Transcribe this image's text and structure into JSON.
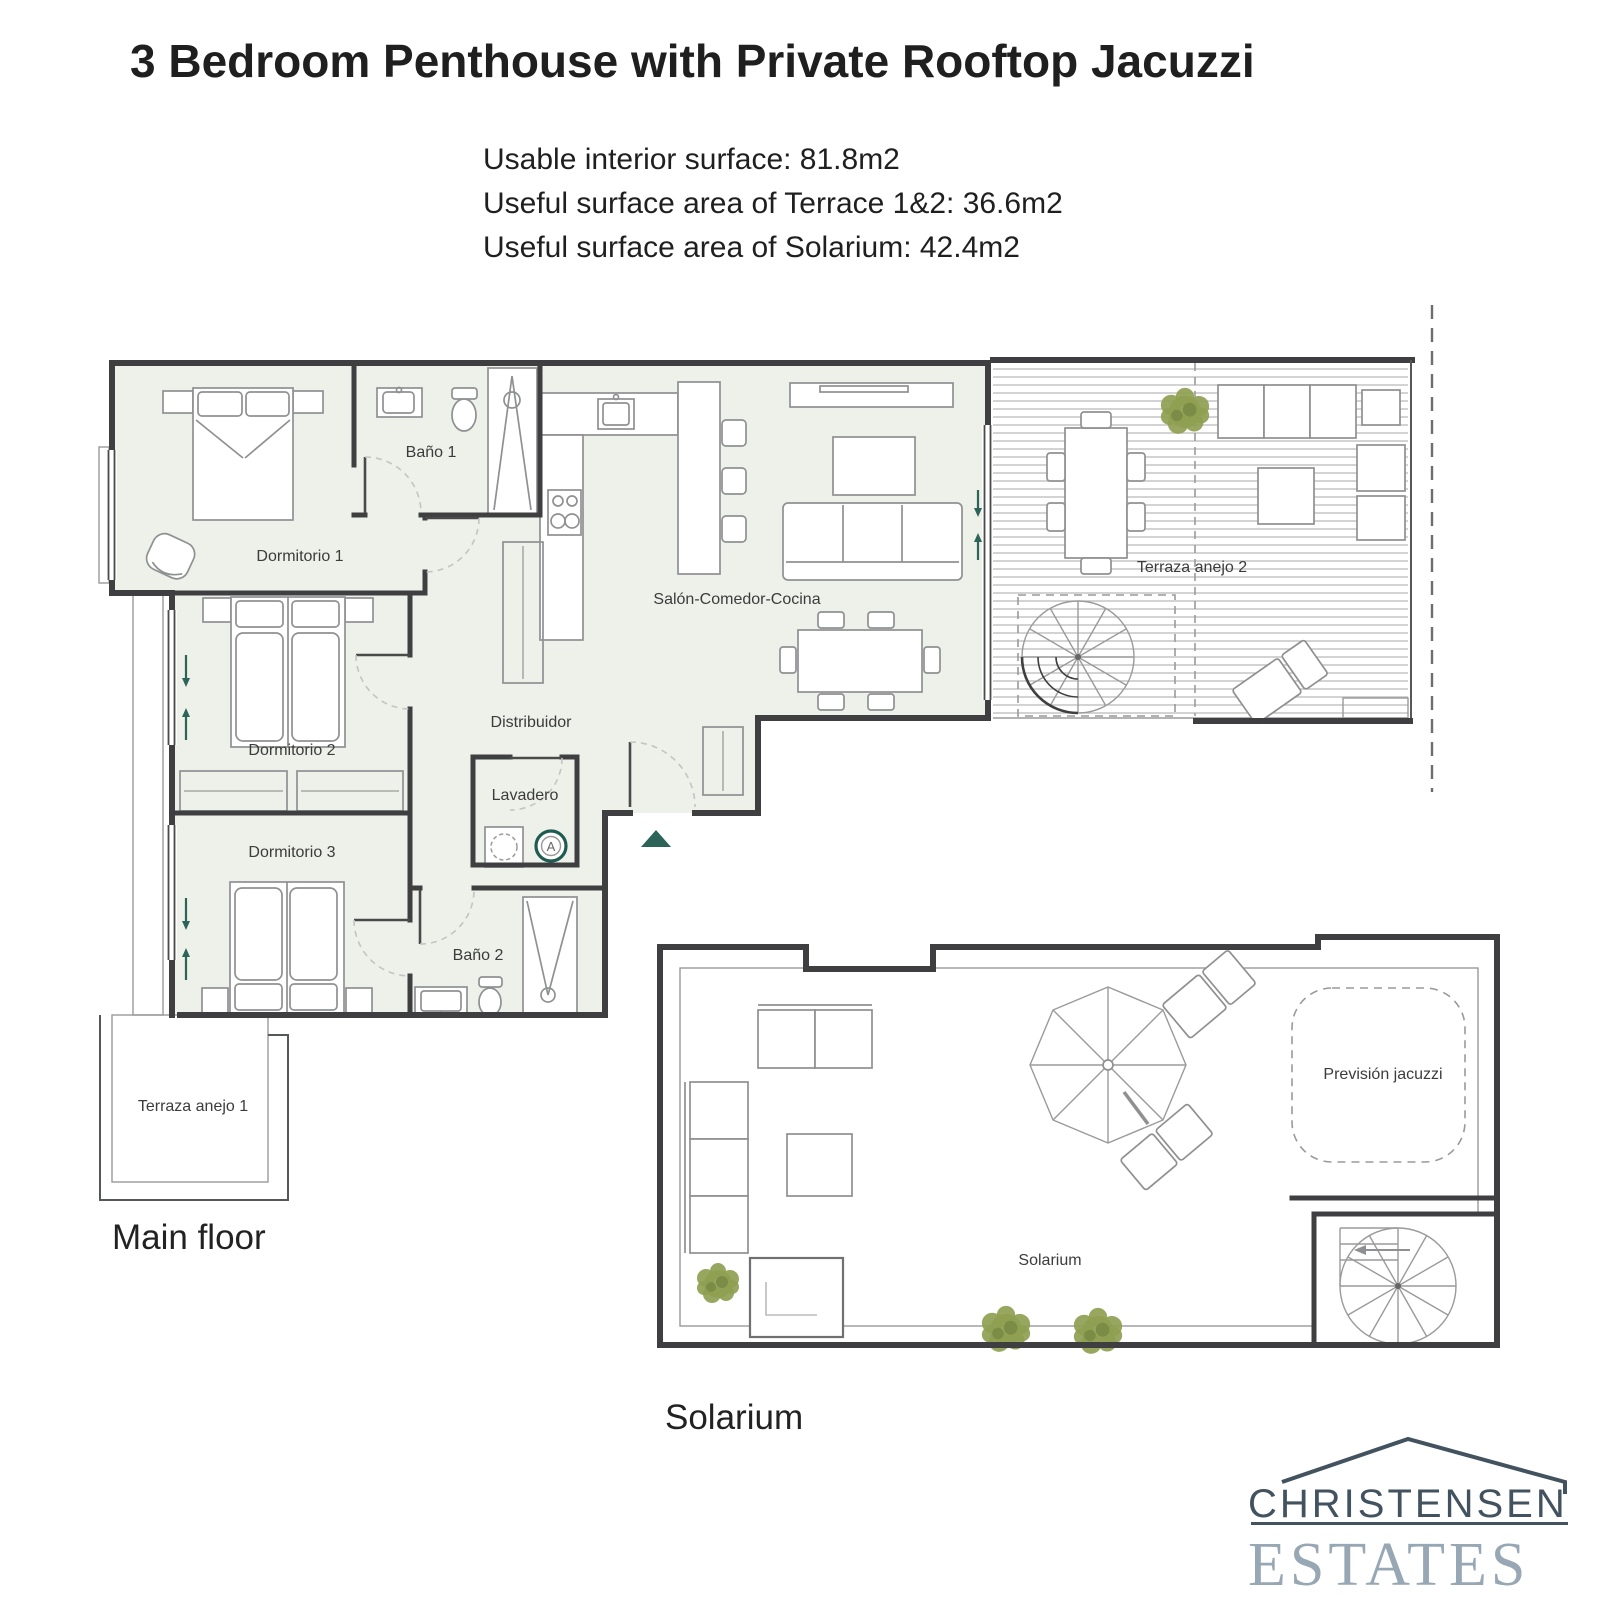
{
  "header": {
    "title": "3 Bedroom Penthouse with Private Rooftop Jacuzzi",
    "surface_lines": [
      "Usable interior surface: 81.8m2",
      "Useful surface area of Terrace 1&2: 36.6m2",
      "Useful surface area of Solarium: 42.4m2"
    ]
  },
  "main_floor": {
    "caption": "Main floor",
    "labels": {
      "dormitorio1": "Dormitorio 1",
      "bano1": "Baño 1",
      "salon_comedor_cocina": "Salón-Comedor-Cocina",
      "distribuidor": "Distribuidor",
      "dormitorio2": "Dormitorio 2",
      "dormitorio3": "Dormitorio 3",
      "lavadero": "Lavadero",
      "bano2": "Baño 2",
      "terraza_anejo_1": "Terraza anejo 1",
      "terraza_anejo_2": "Terraza anejo 2"
    },
    "appliance_marker": "A"
  },
  "solarium": {
    "caption": "Solarium",
    "labels": {
      "solarium": "Solarium",
      "prevision_jacuzzi": "Previsión jacuzzi"
    }
  },
  "logo": {
    "name_line": "CHRISTENSEN",
    "estates_line": "ESTATES"
  },
  "colors": {
    "wall": "#3f3f42",
    "room_fill": "#eef1e9",
    "furniture": "#8f9092",
    "deck_line": "#b5b5b5",
    "plant": "#8fa051",
    "teal": "#2c6459",
    "logo_dark": "#42525e",
    "logo_light": "#97a8b4",
    "text": "#1f1f1f",
    "label": "#3c3c3c"
  }
}
